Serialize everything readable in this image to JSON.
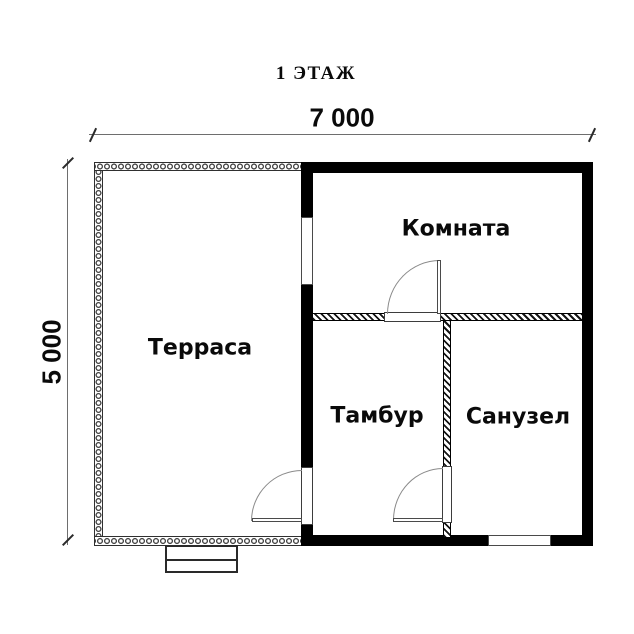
{
  "title": "1 ЭТАЖ",
  "dimensions": {
    "width": "7 000",
    "height": "5 000"
  },
  "rooms": {
    "terrace": "Терраса",
    "living": "Комната",
    "tambour": "Тамбур",
    "bathroom": "Санузел"
  },
  "colors": {
    "wall": "#000000",
    "dim": "#6e6e6e",
    "arc": "#8a8a8a",
    "text": "#0a0a0a",
    "bg": "#ffffff"
  }
}
